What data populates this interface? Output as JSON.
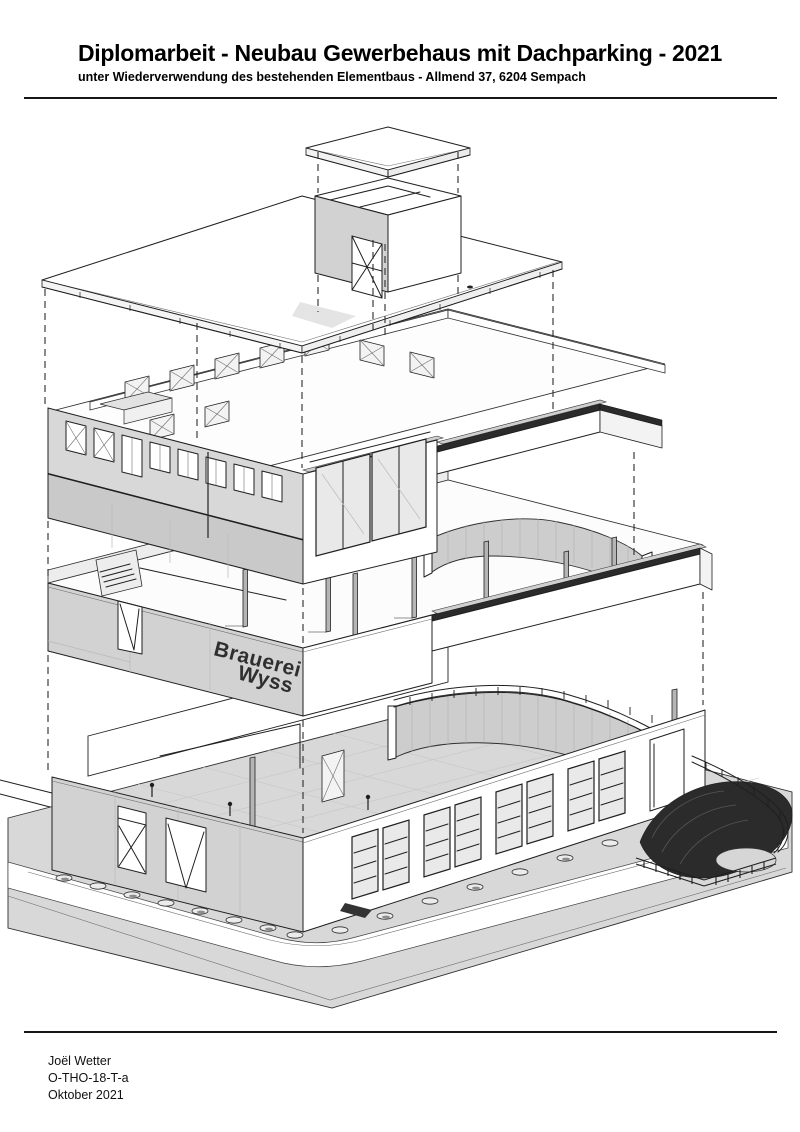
{
  "header": {
    "title": "Diplomarbeit - Neubau Gewerbehaus mit Dachparking - 2021",
    "subtitle": "unter Wiederverwendung des bestehenden Elementbaus - Allmend 37, 6204 Sempach"
  },
  "drawing": {
    "building_sign": {
      "line1": "Brauerei",
      "line2": "Wyss"
    }
  },
  "footer": {
    "author": "Joël Wetter",
    "project_code": "O-THO-18-T-a",
    "date": "Oktober 2021"
  },
  "colors": {
    "line": "#1f1f1f",
    "wall_gray": "#d2d2d2",
    "ground_gray": "#d8d8d8",
    "dark_band": "#2b2b2b",
    "background": "#ffffff"
  }
}
